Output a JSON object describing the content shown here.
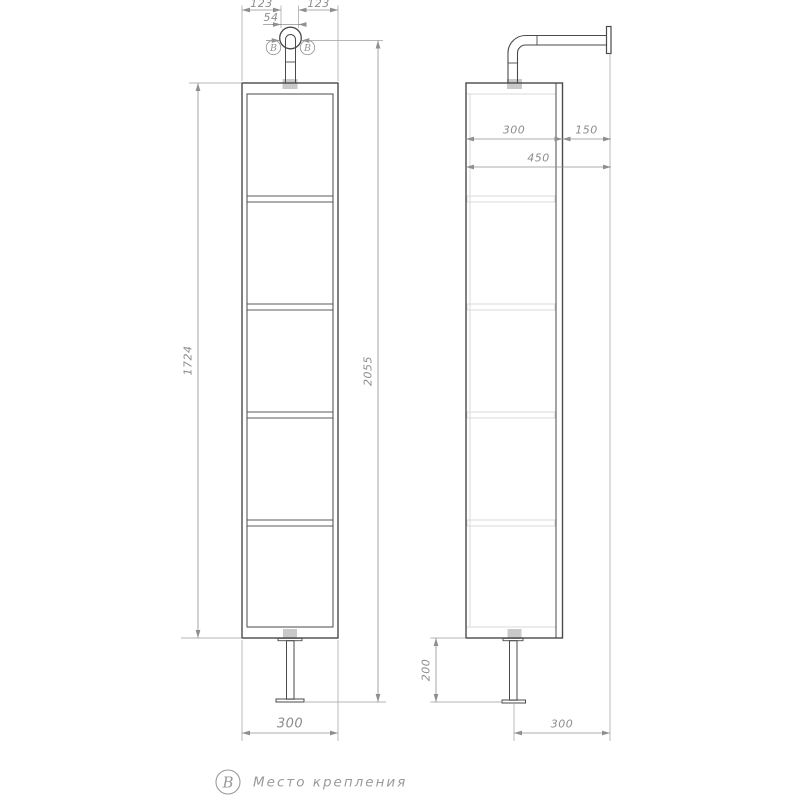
{
  "note": {
    "label": "B",
    "text": "Место крепления"
  },
  "callouts": {
    "left_label": "B",
    "right_label": "B"
  },
  "dims": {
    "top_left": "123",
    "top_right": "123",
    "pin_width": "54",
    "front_height": "1724",
    "total_height": "2055",
    "front_width": "300",
    "side_depth": "300",
    "wall_offset": "150",
    "total_depth": "450",
    "leg_height": "200",
    "bottom_wall_offset": "300"
  },
  "colors": {
    "object_line": "#4a4a4a",
    "dimension_line": "#909090",
    "dimension_text": "#8c8c8c",
    "light_line": "#d9d9d9",
    "tab_fill": "#c9c9c9",
    "background": "#ffffff"
  }
}
